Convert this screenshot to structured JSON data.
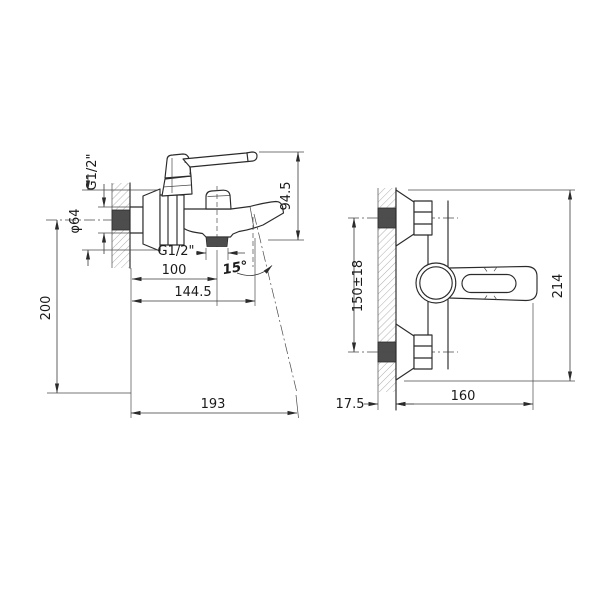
{
  "drawing": {
    "title": "wall-mounted bath mixer faucet technical drawing",
    "views": {
      "left": "side view",
      "right": "front view"
    },
    "labels": {
      "g12_top": "G1/2\"",
      "dia64": "φ64",
      "h200": "200",
      "h94_5": "94.5",
      "g12_bottom": "G1/2\"",
      "w100": "100",
      "w144_5": "144.5",
      "angle15": "15°",
      "w193": "193",
      "mount150": "150±18",
      "h214": "214",
      "w17_5": "17.5",
      "w160": "160"
    },
    "colors": {
      "background": "#ffffff",
      "line": "#2b2b2b",
      "dimension_line": "#3a3a3a",
      "wall_fill": "#4d4d4d",
      "hatch": "#9a9a9a"
    }
  }
}
